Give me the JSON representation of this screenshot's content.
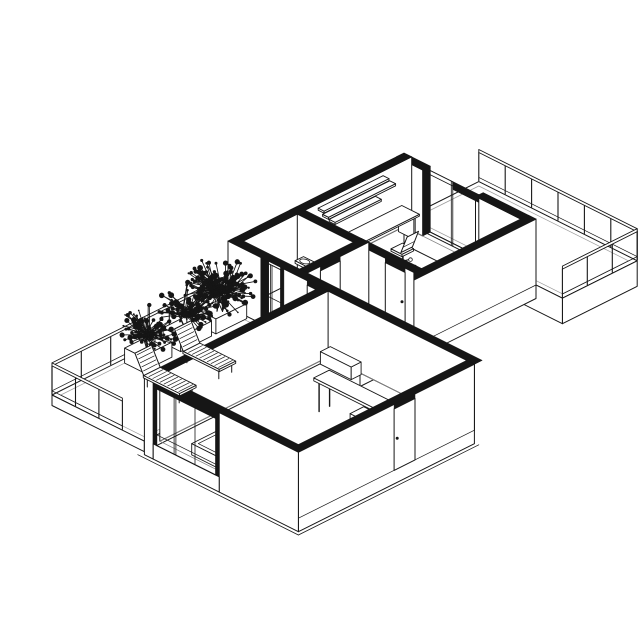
{
  "meta": {
    "subject": "apartment-axonometric-cutaway-floor-plan"
  },
  "colors": {
    "ink": "#161616",
    "paper": "#ffffff",
    "faint": "#9b9b9b",
    "floor_line": "#808080"
  },
  "canvas": {
    "w": 640,
    "h": 640
  },
  "proj": {
    "ox": 140,
    "oy": 351,
    "kx": 22,
    "ky": 11,
    "kz": 30,
    "cut": 2.2
  },
  "scene": {
    "elements": [
      {
        "t": "slab",
        "x": [
          0,
          7.2
        ],
        "y": [
          12,
          15.4
        ],
        "top": 0,
        "bot": -0.85,
        "faces": [
          "+x",
          "-y"
        ],
        "inset": 0.2,
        "name": "east-terrace-slab"
      },
      {
        "t": "rail",
        "p1": [
          0,
          15.4
        ],
        "p2": [
          7.2,
          15.4
        ],
        "n": 6,
        "name": "east-terrace-railing-ne"
      },
      {
        "t": "rail",
        "p1": [
          7.2,
          15.4
        ],
        "p2": [
          7.2,
          12
        ],
        "n": 3,
        "name": "east-terrace-railing-se"
      },
      {
        "t": "fy",
        "y": 11.65,
        "x": [
          0.35,
          1.2
        ],
        "z": [
          0,
          2.2
        ],
        "name": "office-ne-wall"
      },
      {
        "t": "top",
        "x": [
          0,
          1.2
        ],
        "y": [
          11.65,
          12
        ],
        "name": "office-ne-wall-cut"
      },
      {
        "t": "fy",
        "y": 11.65,
        "x": [
          3.6,
          6
        ],
        "z": [
          0,
          2.2
        ],
        "name": "office-ne-wall"
      },
      {
        "t": "top",
        "x": [
          3.6,
          6
        ],
        "y": [
          11.65,
          12
        ],
        "name": "office-ne-wall-cut"
      },
      {
        "t": "fx",
        "x": 1.2,
        "y": [
          11.65,
          12
        ],
        "z": [
          0,
          2.2
        ],
        "f": "ink",
        "name": "glass-door-jamb"
      },
      {
        "t": "glass",
        "pl": "y",
        "at": 11.8,
        "a": [
          1.2,
          3.6
        ],
        "z": [
          0.05,
          2.2
        ],
        "m": [
          2.35,
          2.42
        ],
        "rails": [
          2.06
        ],
        "name": "office-terrace-glass-door"
      },
      {
        "t": "fy",
        "y": 11.79,
        "x": [
          2.42,
          3.6
        ],
        "z": [
          1.95,
          2.2
        ],
        "f": "ink",
        "name": "glass-door-header"
      },
      {
        "t": "fx",
        "x": 0.35,
        "y": [
          4,
          12
        ],
        "z": [
          0,
          2.2
        ],
        "name": "office-nw-wall"
      },
      {
        "t": "top",
        "x": [
          0,
          0.35
        ],
        "y": [
          4,
          12
        ],
        "name": "office-nw-wall-cut"
      },
      {
        "t": "floor",
        "x": [
          0.35,
          5.65
        ],
        "y": [
          7.15,
          11.65
        ],
        "name": "office-floor"
      },
      {
        "t": "box",
        "x": [
          0.45,
          1.15
        ],
        "y": [
          7.5,
          7.56
        ],
        "z": [
          0,
          0.72
        ],
        "name": "desk-leg"
      },
      {
        "t": "box",
        "x": [
          0.45,
          1.15
        ],
        "y": [
          11.3,
          11.36
        ],
        "z": [
          0,
          0.72
        ],
        "name": "desk-leg"
      },
      {
        "t": "box",
        "x": [
          0.4,
          1.2
        ],
        "y": [
          7.4,
          11.5
        ],
        "z": [
          0.72,
          0.78
        ],
        "name": "office-desk"
      },
      {
        "t": "box",
        "x": [
          0.35,
          0.62
        ],
        "y": [
          7.75,
          10.7
        ],
        "z": [
          1.98,
          2.05
        ],
        "name": "wall-shelf"
      },
      {
        "t": "box",
        "x": [
          0.35,
          0.62
        ],
        "y": [
          7.95,
          11
        ],
        "z": [
          1.7,
          1.77
        ],
        "name": "wall-shelf"
      },
      {
        "t": "box",
        "x": [
          0.35,
          0.62
        ],
        "y": [
          8.25,
          10.35
        ],
        "z": [
          1.42,
          1.49
        ],
        "name": "wall-shelf"
      },
      {
        "t": "chair",
        "c": [
          2.05,
          9.9
        ],
        "name": "office-chair"
      },
      {
        "t": "fx",
        "x": 6,
        "y": [
          4,
          12
        ],
        "z": [
          -0.45,
          2.2
        ],
        "pl": 0,
        "name": "upper-block-se-wall"
      },
      {
        "t": "top",
        "x": [
          5.65,
          6
        ],
        "y": [
          4,
          12
        ],
        "name": "upper-block-se-wall-cut"
      },
      {
        "t": "fy",
        "y": 6.8,
        "x": [
          0.35,
          5.65
        ],
        "z": [
          0,
          2.2
        ],
        "name": "bathroom-ne-wall"
      },
      {
        "t": "basin",
        "c": [
          0.95,
          6.5
        ],
        "name": "bathroom-sink"
      },
      {
        "t": "door",
        "pl": "y",
        "at": 6.8,
        "a": [
          4.35,
          5.25
        ],
        "h": 2.05,
        "name": "office-door"
      },
      {
        "t": "top",
        "x": [
          0,
          5.65
        ],
        "y": [
          6.8,
          7.15
        ],
        "name": "bathroom-ne-wall-cut"
      },
      {
        "t": "fx",
        "x": 3.25,
        "y": [
          4,
          7.15
        ],
        "z": [
          0,
          2.2
        ],
        "name": "bathroom-se-wall"
      },
      {
        "t": "door",
        "pl": "x",
        "at": 3.25,
        "a": [
          4.95,
          5.85
        ],
        "h": 2.05,
        "name": "bathroom-door"
      },
      {
        "t": "top",
        "x": [
          2.9,
          3.25
        ],
        "y": [
          4,
          7.15
        ],
        "name": "bathroom-se-wall-cut"
      },
      {
        "t": "floor",
        "x": [
          3.25,
          5.65
        ],
        "y": [
          4,
          6.8
        ],
        "name": "hallway-floor"
      },
      {
        "t": "fy",
        "y": 4,
        "x": [
          0,
          1.5
        ],
        "z": [
          0,
          2.2
        ],
        "name": "southwest-facade"
      },
      {
        "t": "fy",
        "y": 4,
        "x": [
          2.4,
          11.2
        ],
        "z": [
          0,
          2.2
        ],
        "name": "living-nw-wall"
      },
      {
        "t": "fx",
        "x": 1.5,
        "y": [
          4,
          4.35
        ],
        "z": [
          0,
          2.2
        ],
        "f": "ink",
        "name": "facade-glass-jamb"
      },
      {
        "t": "fy",
        "y": 3.99,
        "x": [
          2.4,
          2.55
        ],
        "z": [
          0,
          2.2
        ],
        "f": "ink",
        "name": "facade-glass-jamb"
      },
      {
        "t": "glass",
        "pl": "y",
        "at": 4,
        "a": [
          1.5,
          2.4
        ],
        "z": [
          0.05,
          2.12
        ],
        "m": [
          1.93,
          2
        ],
        "rails": [
          1.02
        ],
        "name": "facade-glass-door"
      },
      {
        "t": "top",
        "x": [
          0,
          11.2
        ],
        "y": [
          4,
          4.35
        ],
        "name": "northwest-wall-cut"
      },
      {
        "t": "door",
        "pl": "y",
        "at": 4,
        "a": [
          3.6,
          4.5
        ],
        "h": 2.05,
        "name": "hallway-door"
      },
      {
        "t": "slab",
        "x": [
          0,
          4.2
        ],
        "y": [
          -4,
          4
        ],
        "top": 0,
        "bot": -0.35,
        "faces": [
          "-y",
          "+x"
        ],
        "inset": 0.2,
        "name": "west-terrace-slab"
      },
      {
        "t": "rail",
        "p1": [
          0,
          4
        ],
        "p2": [
          0,
          -4
        ],
        "n": 6,
        "name": "west-terrace-railing-nw"
      },
      {
        "t": "box",
        "x": [
          0.15,
          0.95
        ],
        "y": [
          2.5,
          3.9
        ],
        "z": [
          0,
          0.5
        ],
        "name": "planter"
      },
      {
        "t": "box",
        "x": [
          0.15,
          0.95
        ],
        "y": [
          0.9,
          2.3
        ],
        "z": [
          0,
          0.5
        ],
        "name": "planter"
      },
      {
        "t": "box",
        "x": [
          0.2,
          1
        ],
        "y": [
          -0.9,
          0.45
        ],
        "z": [
          0,
          0.5
        ],
        "name": "planter"
      },
      {
        "t": "plant",
        "c": [
          0.55,
          3.2,
          1.1
        ],
        "r": 1.15,
        "n": 100,
        "seed": 7,
        "name": "terrace-plant"
      },
      {
        "t": "plant",
        "c": [
          0.55,
          1.6,
          0.95
        ],
        "r": 1,
        "n": 85,
        "seed": 13,
        "name": "terrace-plant"
      },
      {
        "t": "plant",
        "c": [
          0.6,
          -0.2,
          0.9
        ],
        "r": 0.95,
        "n": 80,
        "seed": 29,
        "name": "terrace-plant"
      },
      {
        "t": "plant",
        "c": [
          1.1,
          2.4,
          1.6
        ],
        "r": 1.15,
        "n": 60,
        "seed": 41,
        "name": "terrace-plant-tall"
      },
      {
        "t": "fx",
        "x": 4.55,
        "y": [
          -3.65,
          4
        ],
        "z": [
          0,
          2.2
        ],
        "name": "living-west-wall"
      },
      {
        "t": "top",
        "x": [
          4.2,
          4.55
        ],
        "y": [
          -4,
          4
        ],
        "name": "living-west-wall-cut"
      },
      {
        "t": "floor",
        "x": [
          4.55,
          10.85
        ],
        "y": [
          -3.65,
          4
        ],
        "name": "living-room-floor"
      },
      {
        "t": "box",
        "x": [
          4.7,
          6.1
        ],
        "y": [
          3.5,
          3.95
        ],
        "z": [
          0,
          0.42
        ],
        "name": "sideboard"
      },
      {
        "t": "lines",
        "seg": [
          [
            [
              6.82,
              1.32,
              0
            ],
            [
              6.82,
              1.32,
              1.02
            ]
          ],
          [
            [
              6.82,
              1.8,
              0
            ],
            [
              6.82,
              1.8,
              1.02
            ]
          ],
          [
            [
              9.68,
              1.32,
              0
            ],
            [
              9.68,
              1.32,
              1.02
            ]
          ],
          [
            [
              9.68,
              1.8,
              0
            ],
            [
              9.68,
              1.8,
              1.02
            ]
          ]
        ],
        "sw": 1.4,
        "name": "counter-legs"
      },
      {
        "t": "box",
        "x": [
          8.3,
          9.8
        ],
        "y": [
          1.25,
          1.87
        ],
        "z": [
          0,
          0.5
        ],
        "name": "kitchen-cabinet"
      },
      {
        "t": "box",
        "x": [
          6.7,
          9.8
        ],
        "y": [
          1.2,
          1.9
        ],
        "z": [
          1.02,
          1.12
        ],
        "name": "kitchen-counter"
      },
      {
        "t": "box",
        "x": [
          5.9,
          8.5
        ],
        "y": [
          -3.55,
          -2.35
        ],
        "z": [
          0,
          0.38
        ],
        "inset": 0.15,
        "name": "bed"
      },
      {
        "t": "fx",
        "x": 11.2,
        "y": [
          -4,
          4
        ],
        "z": [
          -0.45,
          2.2
        ],
        "pl": 0,
        "name": "entry-se-wall"
      },
      {
        "t": "top",
        "x": [
          10.85,
          11.2
        ],
        "y": [
          -4,
          4
        ],
        "name": "entry-se-wall-cut"
      },
      {
        "t": "door",
        "pl": "x",
        "at": 11.2,
        "a": [
          0.35,
          1.3
        ],
        "h": 2.05,
        "name": "entry-door"
      },
      {
        "t": "fy",
        "y": -4,
        "x": [
          4.2,
          4.6
        ],
        "z": [
          -0.45,
          2.2
        ],
        "name": "living-sw-wall"
      },
      {
        "t": "fy",
        "y": -4,
        "x": [
          7.6,
          11.2
        ],
        "z": [
          -0.45,
          2.2
        ],
        "name": "living-sw-wall"
      },
      {
        "t": "fy",
        "y": -4,
        "x": [
          4.6,
          7.6
        ],
        "z": [
          1.95,
          2.2
        ],
        "f": "ink",
        "name": "window-header"
      },
      {
        "t": "fy",
        "y": -4,
        "x": [
          4.6,
          7.6
        ],
        "z": [
          -0.45,
          0.06
        ],
        "name": "window-sill"
      },
      {
        "t": "fy",
        "y": -4.001,
        "x": [
          4.6,
          4.76
        ],
        "z": [
          0.06,
          1.95
        ],
        "f": "ink",
        "name": "window-jamb"
      },
      {
        "t": "fy",
        "y": -4.001,
        "x": [
          7.44,
          7.6
        ],
        "z": [
          0.06,
          1.95
        ],
        "f": "ink",
        "name": "window-jamb"
      },
      {
        "t": "glass",
        "pl": "y",
        "at": -4,
        "a": [
          4.76,
          7.44
        ],
        "z": [
          0.06,
          1.95
        ],
        "m": [
          5.55,
          5.63,
          6.5
        ],
        "rails": [
          0.42
        ],
        "name": "living-room-window"
      },
      {
        "t": "top",
        "x": [
          4.2,
          11.2
        ],
        "y": [
          -4,
          -3.65
        ],
        "name": "living-sw-wall-cut"
      },
      {
        "t": "lines",
        "seg": [
          [
            [
              4.05,
              -4.15,
              -0.45
            ],
            [
              11.35,
              -4.15,
              -0.45
            ]
          ],
          [
            [
              11.35,
              -4.15,
              -0.45
            ],
            [
              11.35,
              4.05,
              -0.45
            ]
          ]
        ],
        "sw": 0.8,
        "name": "ground-slab-edge"
      },
      {
        "t": "lounger",
        "x": [
          1.5,
          3.15
        ],
        "y": [
          0.45,
          1.2
        ],
        "name": "sun-lounger"
      },
      {
        "t": "lounger",
        "x": [
          1.7,
          3.35
        ],
        "y": [
          -1.55,
          -0.8
        ],
        "name": "sun-lounger"
      },
      {
        "t": "rail",
        "p1": [
          0,
          -4
        ],
        "p2": [
          3.2,
          -4
        ],
        "n": 3,
        "name": "west-terrace-railing-sw"
      }
    ]
  }
}
